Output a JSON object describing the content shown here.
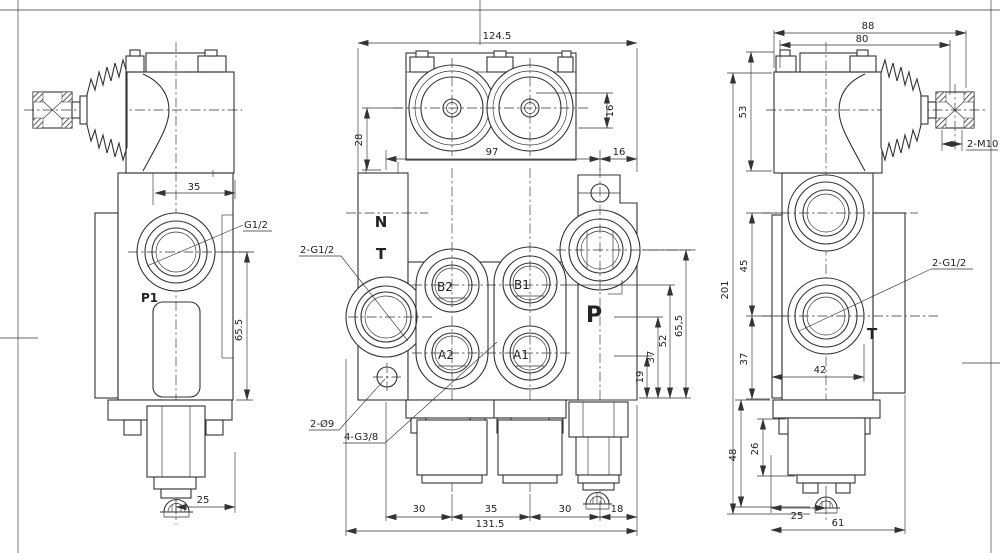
{
  "drawing": {
    "type": "hydraulic directional control valve - 3 view engineering drawing",
    "colors": {
      "line": "#333333",
      "background": "#ffffff"
    }
  },
  "left": {
    "dims": {
      "w35": "35",
      "h65_5": "65.5",
      "b25": "25"
    },
    "labels": {
      "port": "G1/2",
      "p1": "P1"
    }
  },
  "middle": {
    "top": {
      "w124_5": "124.5",
      "h28": "28",
      "h16": "16",
      "w97": "97",
      "w16": "16"
    },
    "front": {
      "n": "N",
      "t": "T",
      "b2": "B2",
      "b1": "B1",
      "a2": "A2",
      "a1": "A1",
      "p": "P",
      "lead_g12": "2-G1/2",
      "lead_d9": "2-Ø9",
      "lead_g38": "4-G3/8"
    },
    "right_dims": {
      "h65_5": "65,5",
      "h52": "52",
      "h37": "37",
      "h19": "19"
    },
    "bottom": {
      "s30a": "30",
      "s35": "35",
      "s30b": "30",
      "s18": "18",
      "total": "131.5"
    }
  },
  "right": {
    "dims": {
      "w88": "88",
      "w80": "80",
      "h53": "53",
      "h201": "201",
      "h45": "45",
      "h37": "37",
      "w42": "42",
      "h48": "48",
      "h26": "26",
      "w25": "25",
      "w61": "61"
    },
    "labels": {
      "m10": "2-M10",
      "g12": "2-G1/2",
      "t": "T"
    }
  }
}
